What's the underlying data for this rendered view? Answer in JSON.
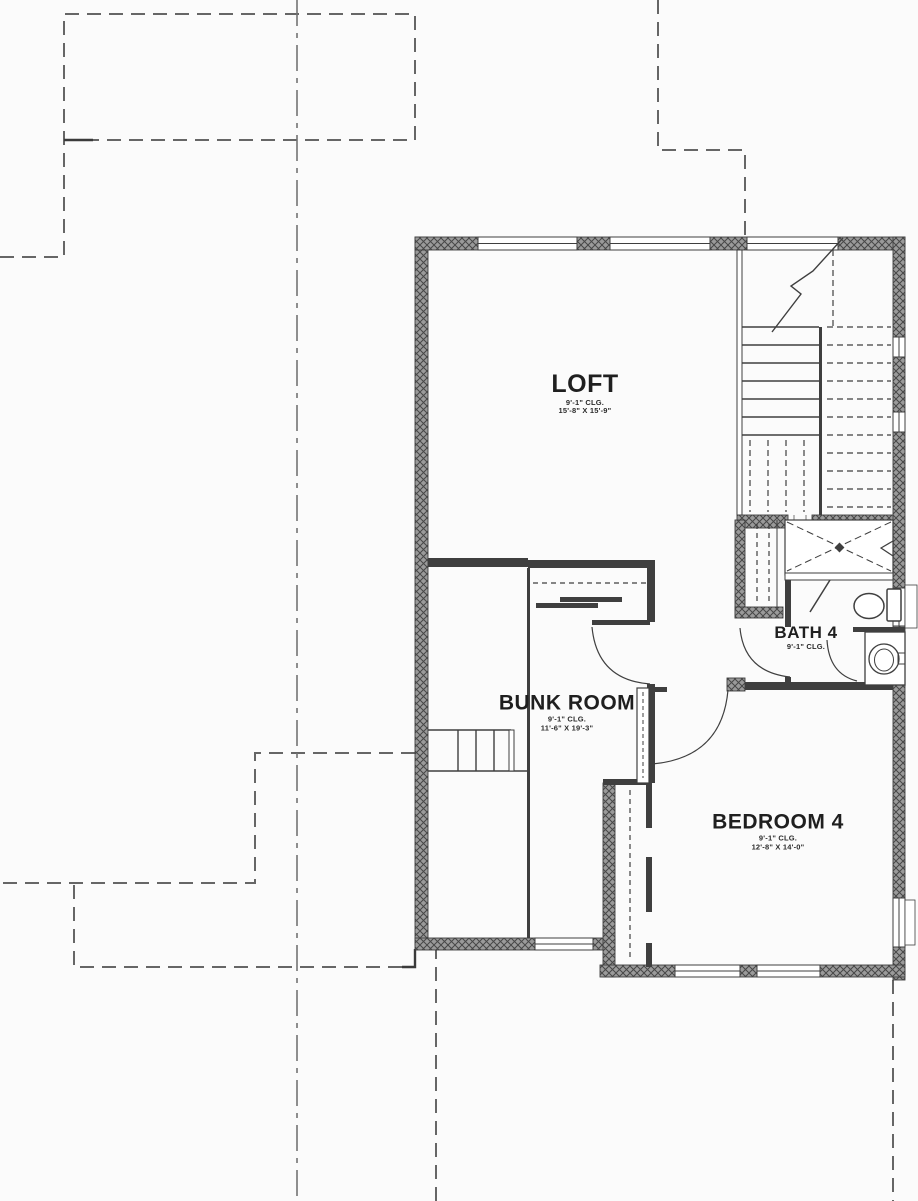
{
  "plan": {
    "rooms": [
      {
        "name": "LOFT",
        "ceiling": "9'-1\" CLG.",
        "size": "15'-8\" X 15'-9\""
      },
      {
        "name": "BUNK ROOM",
        "ceiling": "9'-1\" CLG.",
        "size": "11'-6\" X 19'-3\""
      },
      {
        "name": "BATH 4",
        "ceiling": "9'-1\" CLG.",
        "size": ""
      },
      {
        "name": "BEDROOM 4",
        "ceiling": "9'-1\" CLG.",
        "size": "12'-8\" X 14'-0\""
      }
    ],
    "colors": {
      "wall_fill": "#9a9a9a",
      "line": "#3f3f3f",
      "dashed_line": "#666666",
      "text": "#1f1f1f",
      "background": "#fbfbfb"
    }
  }
}
